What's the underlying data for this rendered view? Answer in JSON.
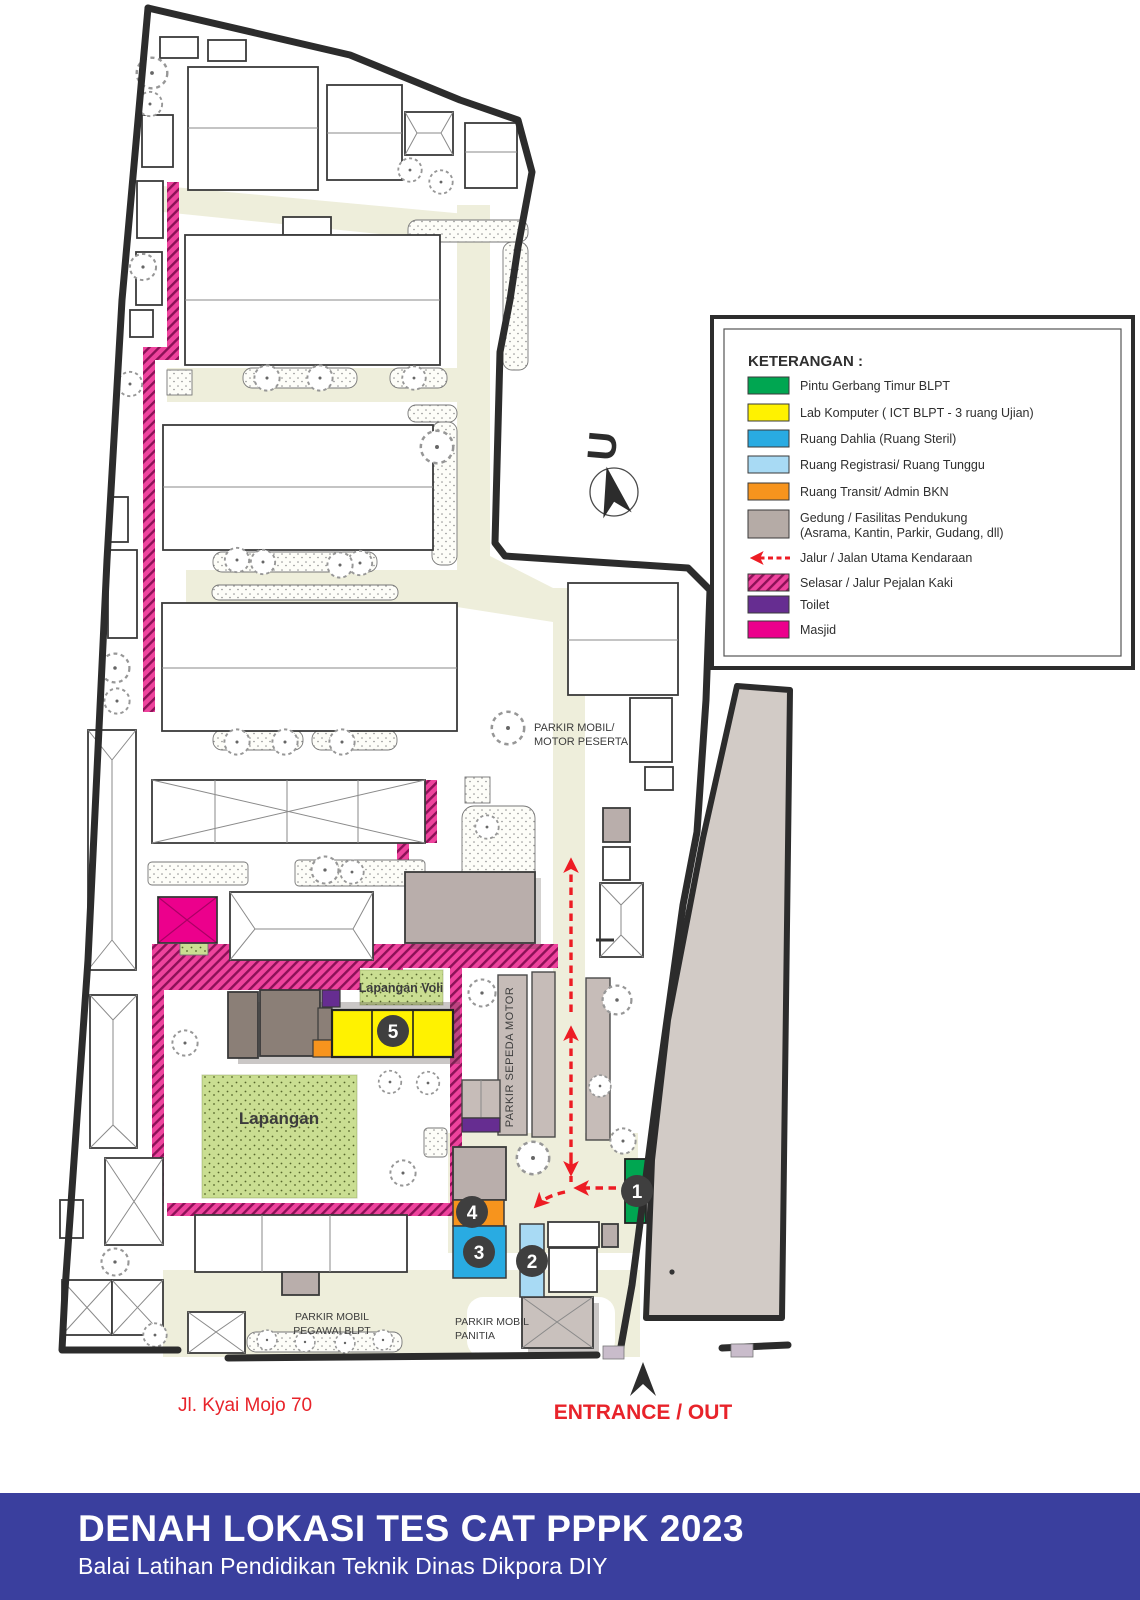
{
  "banner": {
    "title": "DENAH LOKASI TES CAT PPPK 2023",
    "subtitle": "Balai Latihan Pendidikan Teknik Dinas Dikpora DIY"
  },
  "legend": {
    "title": "KETERANGAN :",
    "items": [
      {
        "label": "Pintu Gerbang Timur BLPT",
        "color": "#00a651"
      },
      {
        "label": "Lab Komputer ( ICT BLPT - 3 ruang Ujian)",
        "color": "#fff200"
      },
      {
        "label": "Ruang Dahlia (Ruang Steril)",
        "color": "#29abe2"
      },
      {
        "label": "Ruang Registrasi/ Ruang Tunggu",
        "color": "#a8daf4"
      },
      {
        "label": "Ruang Transit/ Admin BKN",
        "color": "#f7941d"
      },
      {
        "label": "Gedung / Fasilitas Pendukung",
        "label2": "(Asrama, Kantin, Parkir, Gudang, dll)",
        "color": "#b5aba6"
      },
      {
        "label": "Jalur / Jalan Utama Kendaraan",
        "color": "#ed1c24"
      },
      {
        "label": "Selasar / Jalur Pejalan Kaki",
        "color": "#ee439d"
      },
      {
        "label": "Toilet",
        "color": "#662d91"
      },
      {
        "label": "Masjid",
        "color": "#ec008c"
      }
    ]
  },
  "north_label": "U",
  "labels": {
    "parkir_peserta_line1": "PARKIR MOBIL/",
    "parkir_peserta_line2": "MOTOR PESERTA",
    "parkir_sepeda": "PARKIR SEPEDA MOTOR",
    "lapangan_voli": "Lapangan Voli",
    "lapangan": "Lapangan",
    "parkir_pegawai_line1": "PARKIR MOBIL",
    "parkir_pegawai_line2": "PEGAWAI BLPT",
    "parkir_panitia_line1": "PARKIR MOBIL",
    "parkir_panitia_line2": "PANITIA",
    "street_name": "Jl. Kyai Mojo 70",
    "entrance": "ENTRANCE / OUT"
  },
  "markers": {
    "m1": "1",
    "m2": "2",
    "m3": "3",
    "m4": "4",
    "m5": "5"
  },
  "colors": {
    "gate_green": "#00a651",
    "lab_yellow": "#fff200",
    "dahlia_blue": "#29abe2",
    "registrasi_lightblue": "#a8daf4",
    "transit_orange": "#f7941d",
    "support_gray": "#b9aeab",
    "route_red": "#ed1c24",
    "selasar_pink": "#ee439d",
    "toilet_purple": "#662d91",
    "masjid_magenta": "#ec008c",
    "banner_blue": "#3a3f9e",
    "road_cream": "#eeeedb",
    "field_green": "#cade92"
  }
}
